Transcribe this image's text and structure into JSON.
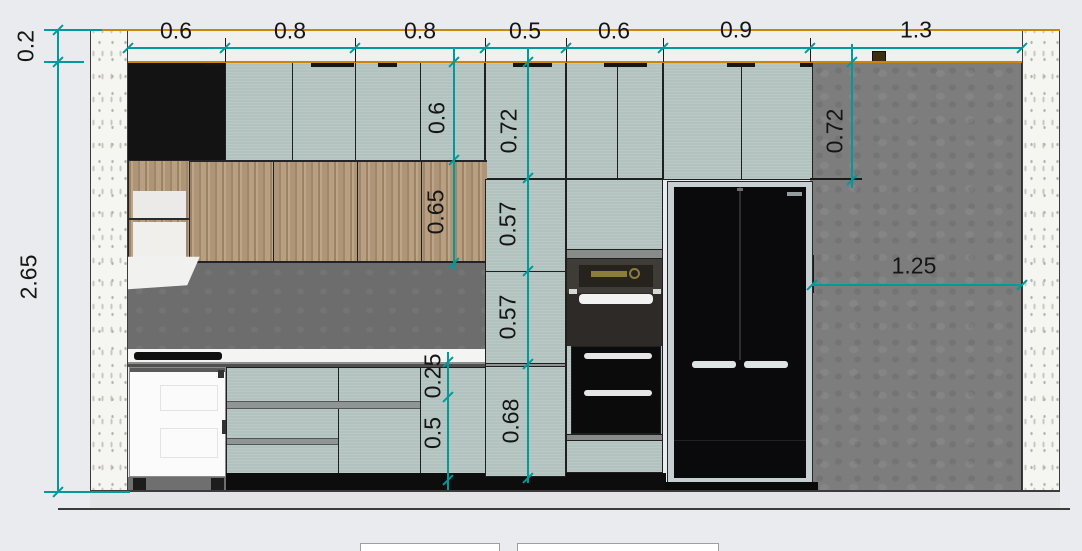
{
  "canvas": {
    "width": 1082,
    "height": 551
  },
  "colors": {
    "background": "#e9ebee",
    "dimension_teal": "#009a9b",
    "ceiling_line_orange": "#c8860b",
    "cabinet_sage": "#b6c6c2",
    "cabinet_wood": "#b49a7c",
    "cabinet_black": "#131313",
    "wall_concrete_gray": "#7d7d7d",
    "wall_section_speckle": "#f5f5f1",
    "backsplash_gray": "#6d6d6d",
    "fridge_black": "#0a0a0c",
    "label_text": "#151515"
  },
  "dimensions": {
    "top_row_widths": [
      "0.6",
      "0.8",
      "0.8",
      "0.5",
      "0.6",
      "0.9",
      "1.3"
    ],
    "left_heights": [
      "0.2",
      "2.65"
    ],
    "upper_cabinet_heights": [
      "0.6",
      "0.72",
      "0.72"
    ],
    "middle_heights": [
      "0.65",
      "0.57",
      "0.57"
    ],
    "base_heights": [
      "0.25",
      "0.5",
      "0.68"
    ],
    "open_wall_span": [
      "1.25"
    ]
  },
  "dim_lines": [
    {
      "o": "h",
      "x": 128,
      "y": 48,
      "len": 894,
      "ticks": [
        0,
        97,
        227,
        357,
        438,
        535,
        682,
        894
      ]
    },
    {
      "o": "v",
      "x": 58,
      "y": 30,
      "len": 462,
      "ticks": [
        0,
        32,
        462
      ]
    },
    {
      "o": "v",
      "x": 454,
      "y": 48,
      "len": 222,
      "ticks": [
        14,
        112,
        215
      ]
    },
    {
      "o": "v",
      "x": 528,
      "y": 48,
      "len": 435,
      "ticks": [
        14,
        130,
        223,
        316,
        430
      ]
    },
    {
      "o": "v",
      "x": 448,
      "y": 352,
      "len": 138,
      "ticks": [
        10,
        45,
        128
      ]
    },
    {
      "o": "v",
      "x": 852,
      "y": 44,
      "len": 144,
      "ticks": [
        18,
        136
      ]
    },
    {
      "o": "h",
      "x": 812,
      "y": 285,
      "len": 210,
      "ticks": [
        0,
        210
      ]
    },
    {
      "o": "h",
      "x": 44,
      "y": 30,
      "len": 58,
      "ticks": []
    },
    {
      "o": "h",
      "x": 44,
      "y": 62,
      "len": 40,
      "ticks": []
    },
    {
      "o": "h",
      "x": 44,
      "y": 492,
      "len": 86,
      "ticks": []
    }
  ],
  "dim_labels": [
    {
      "text": "0.6",
      "x": 176,
      "y": 31,
      "rot": 0
    },
    {
      "text": "0.8",
      "x": 290,
      "y": 31,
      "rot": 0
    },
    {
      "text": "0.8",
      "x": 420,
      "y": 31,
      "rot": 0
    },
    {
      "text": "0.5",
      "x": 525,
      "y": 31,
      "rot": 0
    },
    {
      "text": "0.6",
      "x": 614,
      "y": 31,
      "rot": 0
    },
    {
      "text": "0.9",
      "x": 736,
      "y": 30,
      "rot": 0
    },
    {
      "text": "1.3",
      "x": 916,
      "y": 30,
      "rot": 0
    },
    {
      "text": "0.2",
      "x": 26,
      "y": 46,
      "rot": -90
    },
    {
      "text": "2.65",
      "x": 29,
      "y": 277,
      "rot": -90
    },
    {
      "text": "0.6",
      "x": 437,
      "y": 118,
      "rot": -90
    },
    {
      "text": "0.65",
      "x": 436,
      "y": 212,
      "rot": -90
    },
    {
      "text": "0.72",
      "x": 509,
      "y": 131,
      "rot": -90
    },
    {
      "text": "0.57",
      "x": 508,
      "y": 224,
      "rot": -90
    },
    {
      "text": "0.57",
      "x": 508,
      "y": 317,
      "rot": -90
    },
    {
      "text": "0.25",
      "x": 433,
      "y": 376,
      "rot": -90
    },
    {
      "text": "0.5",
      "x": 433,
      "y": 433,
      "rot": -90
    },
    {
      "text": "0.68",
      "x": 511,
      "y": 421,
      "rot": -90
    },
    {
      "text": "0.72",
      "x": 835,
      "y": 131,
      "rot": -90
    },
    {
      "text": "1.25",
      "x": 914,
      "y": 266,
      "rot": 0
    }
  ]
}
